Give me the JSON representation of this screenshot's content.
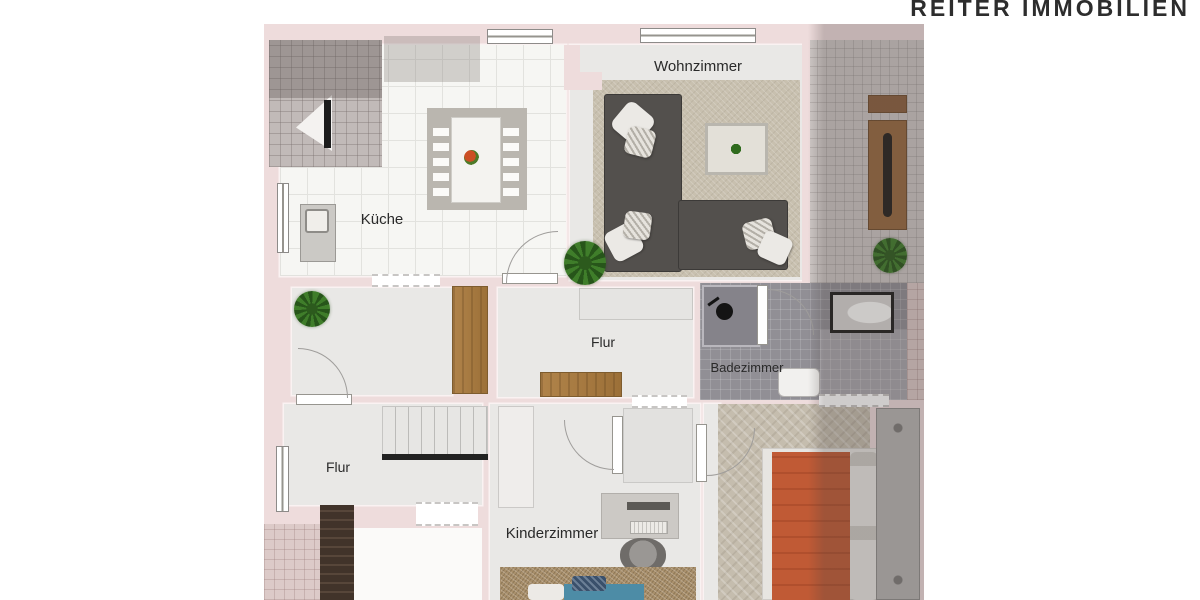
{
  "logo": {
    "text": "REITER IMMOBILIEN",
    "color": "#2d2d2d"
  },
  "rooms": {
    "wohnzimmer": {
      "label": "Wohnzimmer"
    },
    "kueche": {
      "label": "Küche"
    },
    "flur_mitte": {
      "label": "Flur"
    },
    "badezimmer": {
      "label": "Badezimmer"
    },
    "flur_unten": {
      "label": "Flur"
    },
    "kinderzimmer": {
      "label": "Kinderzimmer"
    }
  },
  "palette": {
    "page_background": "#ffffff",
    "wall_pink": "#eedcdc",
    "floor_gray": "#e9e8e6",
    "kitchen_tile": "#f6f6f3",
    "terrace_tile": "#c1bab8",
    "bath_tile": "#918f95",
    "carpet_beige": "#c8c0af",
    "sofa_gray": "#53504d",
    "wood_brown": "#a87c44",
    "bed_orange": "#c05a35",
    "child_bed_blue": "#4d8ca6",
    "label_text": "#2a2a2a"
  }
}
